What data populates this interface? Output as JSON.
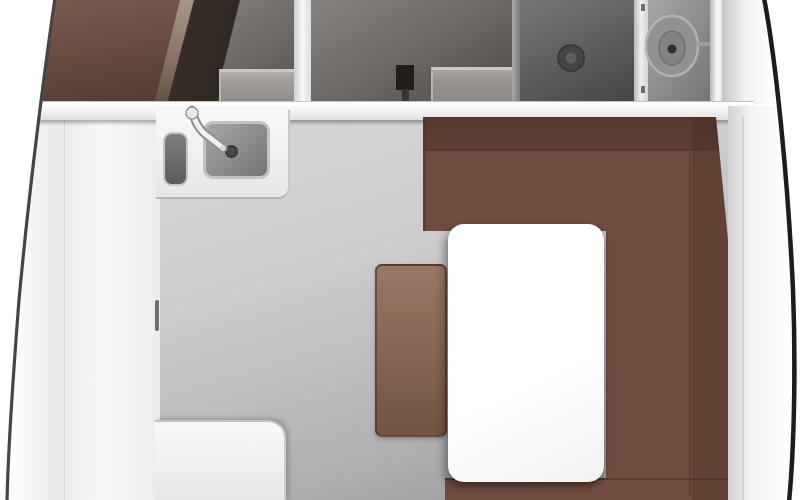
{
  "scene": {
    "name": "sailboat-interior-floor-plan",
    "view": "top-down",
    "rooms": [
      {
        "name": "forward-cabin-entry",
        "features": [
          "angled-door-panel",
          "storage-compartment",
          "step-box"
        ]
      },
      {
        "name": "head-compartment",
        "features": [
          "shower-tray-with-drain",
          "toilet"
        ]
      },
      {
        "name": "galley",
        "features": [
          "counter-with-double-sink",
          "faucet",
          "aft-counter",
          "locker-handle"
        ]
      },
      {
        "name": "salon-dinette",
        "features": [
          "u-shaped-sofa",
          "rectangular-table",
          "ottoman-seat"
        ]
      }
    ]
  },
  "colors": {
    "floor_gray": "#c7c7c9",
    "wall_white": "#f2f2f2",
    "counter_white": "#f0f0f0",
    "sink_gray": "#8a8a8a",
    "door_brown": "#6a4a3b",
    "sofa_brown": "#6f4c3e",
    "ottoman_brown": "#8a6450",
    "table_white": "#fcfcfc",
    "shower_gray": "#5f5f5f",
    "head_gray": "#8e8e8e",
    "hull_port": "#454545",
    "hull_starboard": "#1c1c1c",
    "drain_dark": "#454545",
    "toilet_gray": "#919191"
  }
}
